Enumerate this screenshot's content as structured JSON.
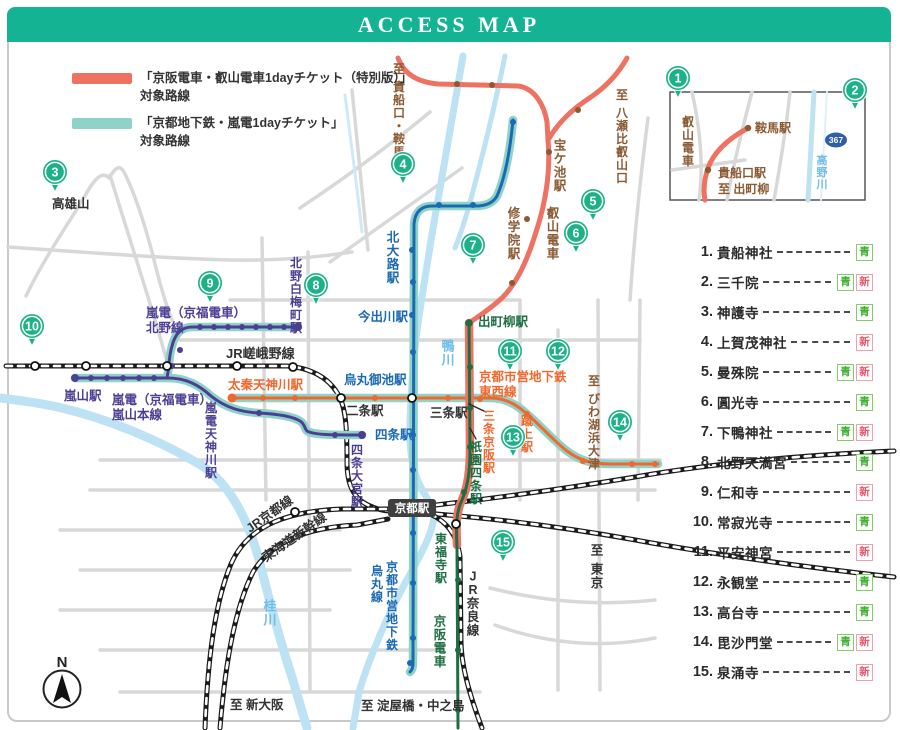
{
  "header": {
    "title": "ACCESS MAP"
  },
  "legend": {
    "items": [
      {
        "swatch": "#ED7262",
        "line1": "「京阪電車・叡山電車1dayチケット（特別版）」",
        "line2": "対象路線"
      },
      {
        "swatch": "#8FD2C8",
        "line1": "「京都地下鉄・嵐電1dayチケット」",
        "line2": "対象路線"
      }
    ]
  },
  "colors": {
    "header": "#14B394",
    "marker": "#1CB287",
    "salmon": "#ED7262",
    "teal": "#8FD2C8",
    "blue": "#1A69B3",
    "orange": "#F0682E",
    "purple": "#4B3F93",
    "keihan_green": "#1D6E42",
    "brown": "#8A5A33",
    "river": "#BCE2F4",
    "river_text": "#6FBDE8",
    "road": "#D8D8D8",
    "jr_black": "#1B1B1B",
    "station_box": "#3F3F3F",
    "route_badge": "#2F5FA8",
    "black_text": "#333333"
  },
  "badge_defs": {
    "aoi": {
      "text": "青",
      "fg": "#3FB032",
      "border": "#86CC66"
    },
    "shin": {
      "text": "新",
      "fg": "#E9566B",
      "border": "#F3A0AE"
    }
  },
  "spots": [
    {
      "no": "1",
      "name": "貴船神社",
      "badges": [
        "aoi"
      ]
    },
    {
      "no": "2",
      "name": "三千院",
      "badges": [
        "aoi",
        "shin"
      ]
    },
    {
      "no": "3",
      "name": "神護寺",
      "badges": [
        "aoi"
      ]
    },
    {
      "no": "4",
      "name": "上賀茂神社",
      "badges": [
        "shin"
      ]
    },
    {
      "no": "5",
      "name": "曼殊院",
      "badges": [
        "aoi",
        "shin"
      ]
    },
    {
      "no": "6",
      "name": "圓光寺",
      "badges": [
        "aoi"
      ]
    },
    {
      "no": "7",
      "name": "下鴨神社",
      "badges": [
        "aoi",
        "shin"
      ]
    },
    {
      "no": "8",
      "name": "北野天満宮",
      "badges": [
        "aoi"
      ]
    },
    {
      "no": "9",
      "name": "仁和寺",
      "badges": [
        "shin"
      ]
    },
    {
      "no": "10",
      "name": "常寂光寺",
      "badges": [
        "aoi"
      ]
    },
    {
      "no": "11",
      "name": "平安神宮",
      "badges": [
        "shin"
      ]
    },
    {
      "no": "12",
      "name": "永観堂",
      "badges": [
        "aoi"
      ]
    },
    {
      "no": "13",
      "name": "高台寺",
      "badges": [
        "aoi"
      ]
    },
    {
      "no": "14",
      "name": "毘沙門堂",
      "badges": [
        "aoi",
        "shin"
      ]
    },
    {
      "no": "15",
      "name": "泉涌寺",
      "badges": [
        "shin"
      ]
    }
  ],
  "map": {
    "kyoto_station": {
      "label": "京都駅"
    },
    "compass": {
      "label": "N"
    },
    "inset": {
      "route_badge": "367"
    },
    "markers": [
      {
        "no": "1",
        "x": 678,
        "y": 78
      },
      {
        "no": "2",
        "x": 855,
        "y": 90
      },
      {
        "no": "3",
        "x": 55,
        "y": 172
      },
      {
        "no": "4",
        "x": 403,
        "y": 164
      },
      {
        "no": "5",
        "x": 593,
        "y": 201
      },
      {
        "no": "6",
        "x": 576,
        "y": 233
      },
      {
        "no": "7",
        "x": 473,
        "y": 245
      },
      {
        "no": "8",
        "x": 316,
        "y": 285
      },
      {
        "no": "9",
        "x": 210,
        "y": 283
      },
      {
        "no": "10",
        "x": 32,
        "y": 326
      },
      {
        "no": "11",
        "x": 510,
        "y": 351
      },
      {
        "no": "12",
        "x": 558,
        "y": 351
      },
      {
        "no": "13",
        "x": 513,
        "y": 437
      },
      {
        "no": "14",
        "x": 620,
        "y": 422
      },
      {
        "no": "15",
        "x": 503,
        "y": 542
      }
    ],
    "labels": [
      {
        "id": "to-kibuneguchi-kurama",
        "text": "至 貴船口・鞍馬",
        "x": 399,
        "y": 62,
        "color": "#8A5A33",
        "v": true,
        "size": 12
      },
      {
        "id": "to-yase-hieizanguchi",
        "text": "至 八瀬比叡山口",
        "x": 622,
        "y": 88,
        "color": "#8A5A33",
        "v": true,
        "size": 12
      },
      {
        "id": "takaragaike-sta",
        "text": "宝ケ池駅",
        "x": 560,
        "y": 138,
        "color": "#8A5A33",
        "v": true,
        "size": 12.5
      },
      {
        "id": "shugakuin-sta",
        "text": "修学院駅",
        "x": 514,
        "y": 206,
        "color": "#8A5A33",
        "v": true,
        "size": 12.5
      },
      {
        "id": "eizan-densha",
        "text": "叡山電車",
        "x": 553,
        "y": 206,
        "color": "#8A5A33",
        "v": true,
        "size": 12.5
      },
      {
        "id": "to-biwako-hamaotsu",
        "text": "至 びわ湖浜大津",
        "x": 594,
        "y": 374,
        "color": "#8A5A33",
        "v": true,
        "size": 12
      },
      {
        "id": "kitaoji-sta",
        "text": "北大路駅",
        "x": 393,
        "y": 230,
        "color": "#1A69B3",
        "v": true,
        "size": 12.5
      },
      {
        "id": "imadegawa-sta",
        "text": "今出川駅",
        "x": 358,
        "y": 321,
        "color": "#1A69B3",
        "v": false,
        "size": 12.5
      },
      {
        "id": "karasuma-oike-sta",
        "text": "烏丸御池駅",
        "x": 344,
        "y": 384,
        "color": "#1A69B3",
        "v": false,
        "size": 12.5
      },
      {
        "id": "shijo-sta",
        "text": "四条駅",
        "x": 375,
        "y": 439,
        "color": "#1A69B3",
        "v": false,
        "size": 12.5
      },
      {
        "id": "karasuma-line-1",
        "text": "京都市営地下鉄",
        "x": 392,
        "y": 560,
        "color": "#1A69B3",
        "v": true,
        "size": 12
      },
      {
        "id": "karasuma-line-2",
        "text": "烏丸線",
        "x": 377,
        "y": 564,
        "color": "#1A69B3",
        "v": true,
        "size": 12
      },
      {
        "id": "kitano-hakubaicho-sta",
        "text": "北野白梅町駅",
        "x": 296,
        "y": 256,
        "color": "#4B3F93",
        "v": true,
        "size": 12
      },
      {
        "id": "randen-kitano-1",
        "text": "嵐電（京福電車）",
        "x": 146,
        "y": 317,
        "color": "#4B3F93",
        "v": false,
        "size": 12.5
      },
      {
        "id": "randen-kitano-2",
        "text": "北野線",
        "x": 146,
        "y": 332,
        "color": "#4B3F93",
        "v": false,
        "size": 12.5
      },
      {
        "id": "arashiyama-sta",
        "text": "嵐山駅",
        "x": 64,
        "y": 400,
        "color": "#4B3F93",
        "v": false,
        "size": 12.5
      },
      {
        "id": "randen-arashiyama-1",
        "text": "嵐電（京福電車）",
        "x": 112,
        "y": 404,
        "color": "#4B3F93",
        "v": false,
        "size": 12.5
      },
      {
        "id": "randen-arashiyama-2",
        "text": "嵐山本線",
        "x": 112,
        "y": 419,
        "color": "#4B3F93",
        "v": false,
        "size": 12.5
      },
      {
        "id": "randen-tenjingawa-sta",
        "text": "嵐電天神川駅",
        "x": 211,
        "y": 401,
        "color": "#4B3F93",
        "v": true,
        "size": 12
      },
      {
        "id": "shijo-omiya-sta",
        "text": "四条大宮駅",
        "x": 357,
        "y": 443,
        "color": "#4B3F93",
        "v": true,
        "size": 12
      },
      {
        "id": "uzumasa-tenjingawa-sta",
        "text": "太秦天神川駅",
        "x": 228,
        "y": 389,
        "color": "#F0682E",
        "v": false,
        "size": 12.5
      },
      {
        "id": "tozai-line-1",
        "text": "京都市営地下鉄",
        "x": 479,
        "y": 381,
        "color": "#F0682E",
        "v": false,
        "size": 12.5
      },
      {
        "id": "tozai-line-2",
        "text": "東西線",
        "x": 479,
        "y": 396,
        "color": "#F0682E",
        "v": false,
        "size": 12.5
      },
      {
        "id": "sanjo-keihan-sta",
        "text": "三条京阪駅",
        "x": 489,
        "y": 409,
        "color": "#F0682E",
        "v": true,
        "size": 12
      },
      {
        "id": "keage-sta",
        "text": "蹴上駅",
        "x": 527,
        "y": 414,
        "color": "#F0682E",
        "v": true,
        "size": 12
      },
      {
        "id": "demachiyanagi-sta",
        "text": "出町柳駅",
        "x": 478,
        "y": 326,
        "color": "#1D6E42",
        "v": false,
        "size": 12.5
      },
      {
        "id": "gion-shijo-sta",
        "text": "祇園四条駅",
        "x": 476,
        "y": 440,
        "color": "#1D6E42",
        "v": true,
        "size": 12
      },
      {
        "id": "tofukuji-sta",
        "text": "東福寺駅",
        "x": 441,
        "y": 532,
        "color": "#1D6E42",
        "v": true,
        "size": 12
      },
      {
        "id": "keihan-densha",
        "text": "京阪電車",
        "x": 440,
        "y": 614,
        "color": "#1D6E42",
        "v": true,
        "size": 12.5
      },
      {
        "id": "takao-san",
        "text": "高雄山",
        "x": 52,
        "y": 208,
        "color": "#333333",
        "v": false,
        "size": 12.5
      },
      {
        "id": "jr-sagano-line",
        "text": "JR嵯峨野線",
        "x": 226,
        "y": 358,
        "color": "#333333",
        "v": false,
        "size": 13
      },
      {
        "id": "nijo-sta",
        "text": "二条駅",
        "x": 346,
        "y": 415,
        "color": "#333333",
        "v": false,
        "size": 12.5
      },
      {
        "id": "sanjo-sta",
        "text": "三条駅",
        "x": 430,
        "y": 417,
        "color": "#333333",
        "v": false,
        "size": 12.5
      },
      {
        "id": "jr-nara-line",
        "text": "JR奈良線",
        "x": 473,
        "y": 569,
        "color": "#333333",
        "v": true,
        "size": 12.5
      },
      {
        "id": "to-tokyo",
        "text": "至 東京",
        "x": 597,
        "y": 543,
        "color": "#333333",
        "v": true,
        "size": 12.5
      },
      {
        "id": "to-shin-osaka",
        "text": "至 新大阪",
        "x": 230,
        "y": 709,
        "color": "#333333",
        "v": false,
        "size": 12.5
      },
      {
        "id": "to-yodoyabashi-nakanoshima",
        "text": "至 淀屋橋・中之島",
        "x": 361,
        "y": 710,
        "color": "#333333",
        "v": false,
        "size": 12.5
      },
      {
        "id": "jr-kyoto-line",
        "text": "JR京都線",
        "x": 250,
        "y": 533,
        "color": "#333333",
        "v": false,
        "size": 12.5,
        "rotate": -35
      },
      {
        "id": "tokaido-shinkansen",
        "text": "東海道新幹線",
        "x": 266,
        "y": 562,
        "color": "#333333",
        "v": false,
        "size": 12.5,
        "rotate": -35
      },
      {
        "id": "kamo-gawa",
        "text": "鴨川",
        "x": 448,
        "y": 339,
        "color": "#6FBDE8",
        "v": true,
        "size": 13
      },
      {
        "id": "katsura-gawa",
        "text": "桂川",
        "x": 270,
        "y": 599,
        "color": "#6FBDE8",
        "v": true,
        "size": 13
      },
      {
        "id": "inset-takano-gawa",
        "text": "高野川",
        "x": 822,
        "y": 154,
        "color": "#6FBDE8",
        "v": true,
        "size": 11
      },
      {
        "id": "inset-eizan-densha",
        "text": "叡山電車",
        "x": 688,
        "y": 115,
        "color": "#8A5A33",
        "v": true,
        "size": 12
      },
      {
        "id": "inset-kurama-sta",
        "text": "鞍馬駅",
        "x": 755,
        "y": 132,
        "color": "#8A5A33",
        "v": false,
        "size": 12
      },
      {
        "id": "inset-kibuneguchi-sta",
        "text": "貴船口駅",
        "x": 718,
        "y": 177,
        "color": "#8A5A33",
        "v": false,
        "size": 12
      },
      {
        "id": "inset-to-demachiyanagi",
        "text": "至 出町柳",
        "x": 718,
        "y": 193,
        "color": "#8A5A33",
        "v": false,
        "size": 12
      }
    ]
  }
}
